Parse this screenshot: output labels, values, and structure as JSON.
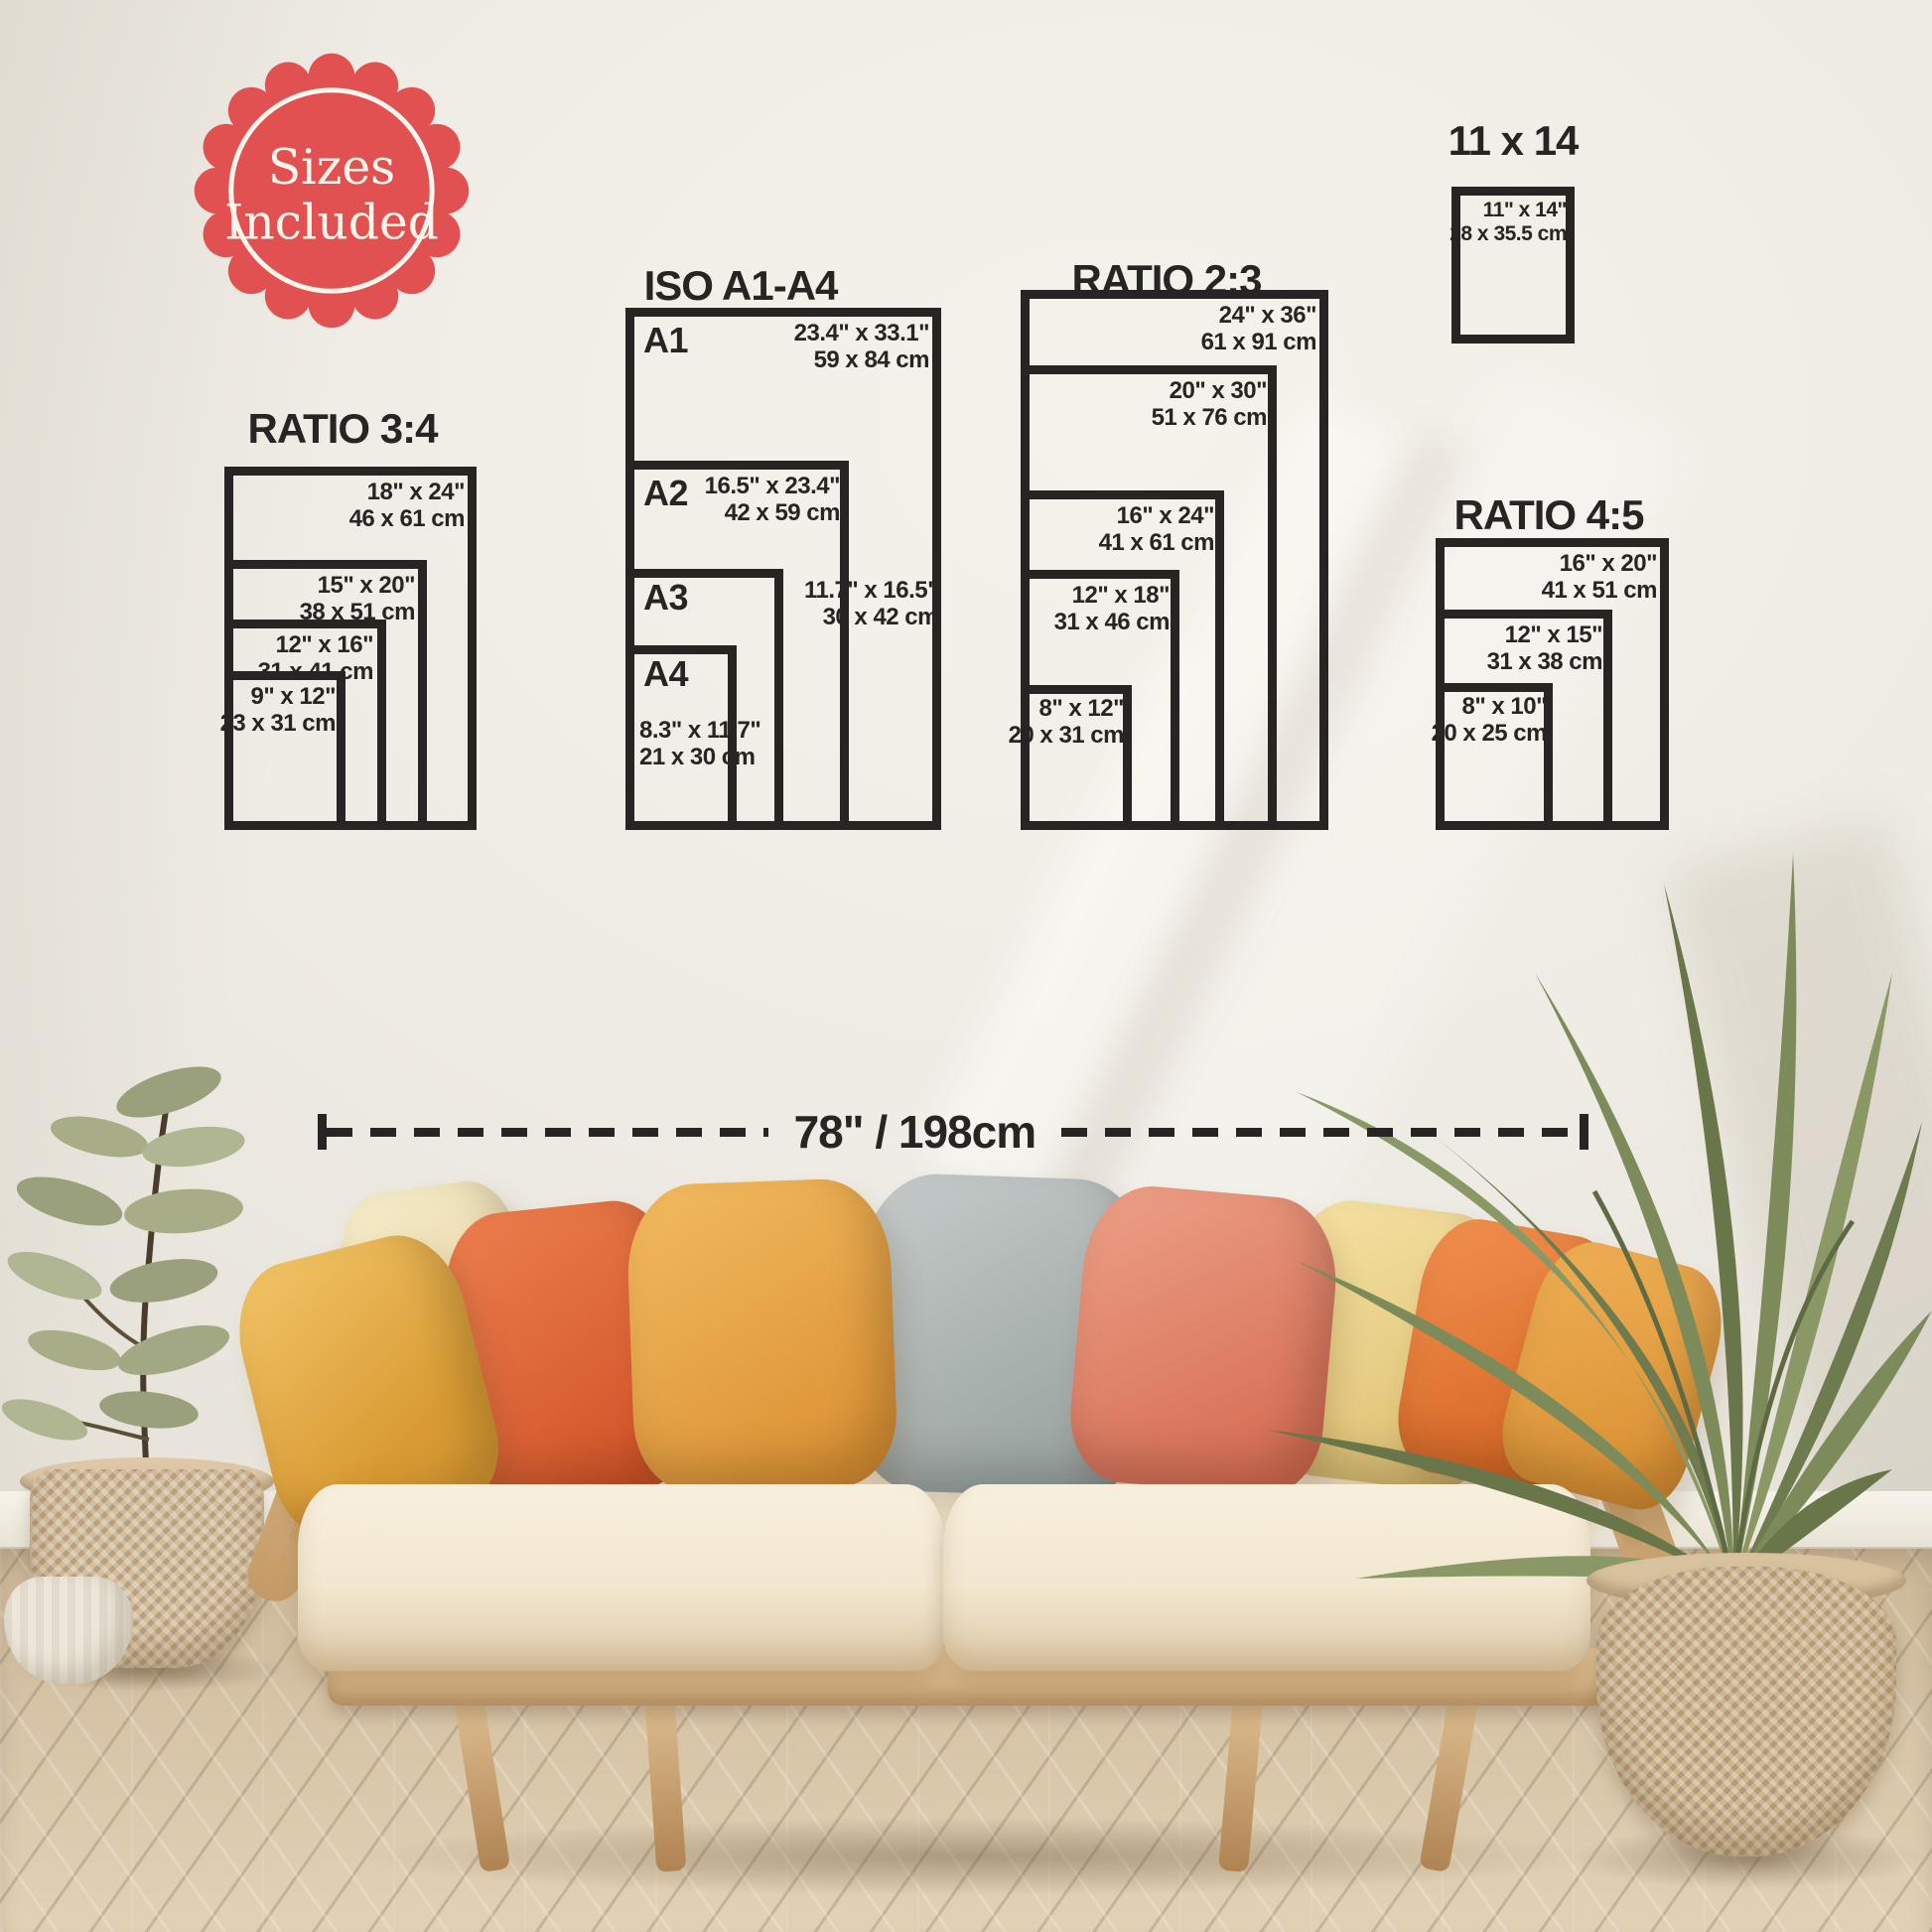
{
  "badge": {
    "line1": "Sizes",
    "line2": "Included"
  },
  "groups": {
    "ratio34": {
      "title": "RATIO 3:4",
      "sizes": [
        {
          "inch": "18\" x 24\"",
          "cm": "46 x 61 cm"
        },
        {
          "inch": "15\" x 20\"",
          "cm": "38 x 51 cm"
        },
        {
          "inch": "12\" x 16\"",
          "cm": "31 x 41 cm"
        },
        {
          "inch": "9\" x 12\"",
          "cm": "23 x 31 cm"
        }
      ]
    },
    "iso": {
      "title": "ISO A1-A4",
      "sizes": [
        {
          "label": "A1",
          "inch": "23.4\" x 33.1\"",
          "cm": "59 x 84 cm"
        },
        {
          "label": "A2",
          "inch": "16.5\" x 23.4\"",
          "cm": "42 x 59 cm"
        },
        {
          "label": "A3",
          "inch": "11.7\" x 16.5\"",
          "cm": "30 x 42 cm"
        },
        {
          "label": "A4",
          "inch": "8.3\" x 11.7\"",
          "cm": "21 x 30 cm"
        }
      ]
    },
    "ratio23": {
      "title": "RATIO 2:3",
      "sizes": [
        {
          "inch": "24\" x 36\"",
          "cm": "61 x 91 cm"
        },
        {
          "inch": "20\" x 30\"",
          "cm": "51 x 76 cm"
        },
        {
          "inch": "16\" x 24\"",
          "cm": "41 x 61 cm"
        },
        {
          "inch": "12\" x 18\"",
          "cm": "31 x 46 cm"
        },
        {
          "inch": "8\" x 12\"",
          "cm": "20 x 31 cm"
        }
      ]
    },
    "s11x14": {
      "title": "11 x 14",
      "sizes": [
        {
          "inch": "11\" x 14\"",
          "cm": "28 x 35.5 cm"
        }
      ]
    },
    "ratio45": {
      "title": "RATIO 4:5",
      "sizes": [
        {
          "inch": "16\" x 20\"",
          "cm": "41 x 51 cm"
        },
        {
          "inch": "12\" x 15\"",
          "cm": "31 x 38 cm"
        },
        {
          "inch": "8\" x 10\"",
          "cm": "20 x 25 cm"
        }
      ]
    }
  },
  "measurement": {
    "label": "78\" / 198cm"
  },
  "colors": {
    "badge_red": "#e25151",
    "ink": "#262523",
    "wall": "#eeebe4",
    "floor_wood": "#d5c2a4",
    "sofa_wood": "#d9b98c",
    "cushion_cream": "#f3ead8",
    "pillows": [
      "#e8b04a",
      "#f0e5c4",
      "#dd6436",
      "#e8a344",
      "#aeb6b3",
      "#e08168",
      "#ecd393",
      "#e57a32",
      "#e5a246"
    ]
  }
}
